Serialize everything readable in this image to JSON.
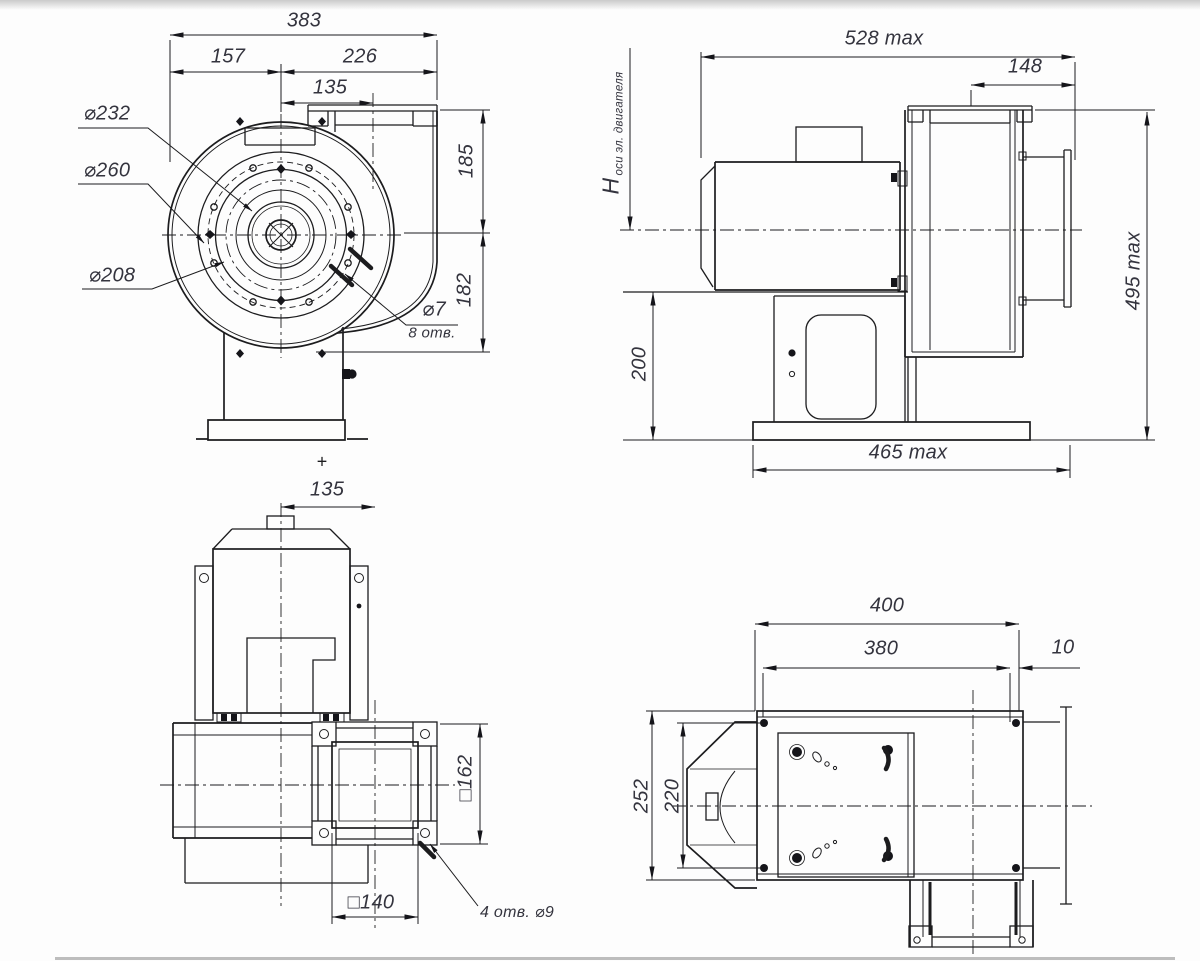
{
  "drawing": {
    "type": "centrifugal-fan dimensional drawing, 4 orthographic views",
    "line_color": "#1c1c1e",
    "text_color": "#34343e",
    "background": "#fdfdfd",
    "views": {
      "front": {
        "dims": {
          "overall_width": "383",
          "axis_to_left": "157",
          "axis_to_right": "226",
          "axis_to_outlet": "135",
          "outlet_height": "185",
          "axis_to_base": "182"
        },
        "labels": {
          "bolt_circle": "⌀232",
          "flange_outer": "⌀260",
          "inlet_inner": "⌀208",
          "hole_dia": "⌀7",
          "hole_count": "8 отв.",
          "center_mark": "+"
        }
      },
      "side": {
        "dims": {
          "overall_length": "528 max",
          "inlet_depth": "148",
          "overall_height": "495 max",
          "pedestal_height": "200",
          "base_length": "465 max"
        },
        "labels": {
          "axis_height_symbol": "H",
          "axis_height_note": "оси эл. двигателя"
        }
      },
      "top": {
        "dims": {
          "axis_to_outlet": "135",
          "outlet_flange_square": "□162",
          "outlet_duct_square": "□140"
        },
        "labels": {
          "flange_holes_note": "4 отв. ⌀9"
        }
      },
      "bottom": {
        "dims": {
          "base_length": "400",
          "holes_span_length": "380",
          "edge_offset": "10",
          "base_width": "252",
          "holes_span_width": "220"
        }
      }
    }
  }
}
